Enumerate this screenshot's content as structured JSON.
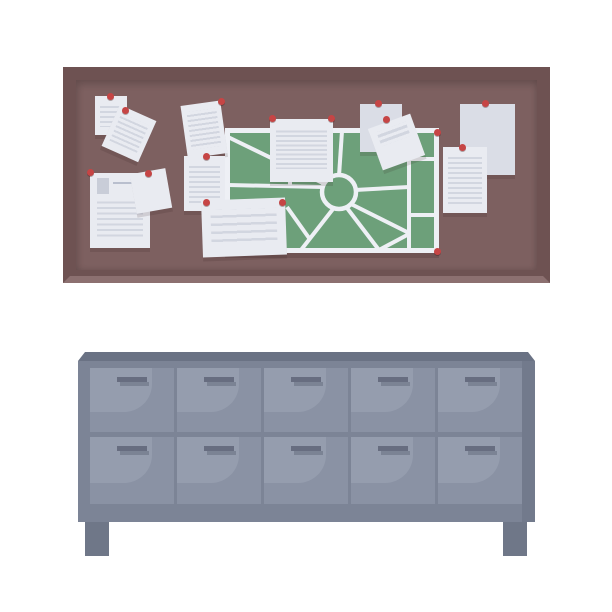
{
  "scene": {
    "description": "flat illustration of a detective evidence cork board with pinned papers and a city map above a gray filing cabinet",
    "background_color": "#ffffff"
  },
  "board": {
    "frame_color": "#6e5252",
    "frame_bevel_color": "#8c7070",
    "surface_color": "#7d6060",
    "pin_color": "#c64545",
    "paper_color": "#e9ebf1",
    "paper_alt_color": "#dadde6",
    "line_color": "#d2d6e0",
    "photo_color": "#c9cdd8",
    "map": {
      "x": 225,
      "y": 128,
      "w": 214,
      "h": 125,
      "land_color": "#6da07a",
      "road_color": "#eef0f5",
      "roundabout": {
        "cx": 114,
        "cy": 64,
        "r": 17
      },
      "roads": [
        [
          3,
          9,
          112,
          62
        ],
        [
          117,
          3,
          114,
          48
        ],
        [
          130,
          62,
          184,
          59
        ],
        [
          184,
          3,
          184,
          122
        ],
        [
          184,
          31,
          211,
          31
        ],
        [
          184,
          87,
          211,
          87
        ],
        [
          126,
          76,
          184,
          105
        ],
        [
          108,
          81,
          76,
          122
        ],
        [
          122,
          80,
          154,
          122
        ],
        [
          154,
          122,
          184,
          106
        ],
        [
          3,
          57,
          98,
          59
        ],
        [
          65,
          57,
          65,
          38
        ],
        [
          62,
          79,
          84,
          110
        ],
        [
          3,
          98,
          40,
          122
        ]
      ]
    },
    "papers": [
      {
        "name": "blank-sheet-back",
        "style": "blank",
        "shade": "alt",
        "x": 360,
        "y": 104,
        "w": 42,
        "h": 48,
        "rot": 0
      },
      {
        "name": "blank-sheet-right",
        "style": "blank",
        "shade": "alt",
        "x": 460,
        "y": 104,
        "w": 55,
        "h": 71,
        "rot": 0
      },
      {
        "name": "case-document",
        "style": "document",
        "shade": "main",
        "x": 90,
        "y": 173,
        "w": 60,
        "h": 75,
        "rot": 0
      },
      {
        "name": "blank-note",
        "style": "blank",
        "shade": "main",
        "x": 133,
        "y": 171,
        "w": 36,
        "h": 40,
        "rot": -10
      },
      {
        "name": "small-note",
        "style": "lined",
        "shade": "main",
        "x": 95,
        "y": 96,
        "w": 32,
        "h": 39,
        "rot": 0
      },
      {
        "name": "tilted-note",
        "style": "lined",
        "shade": "main",
        "x": 109,
        "y": 111,
        "w": 40,
        "h": 45,
        "rot": 24
      },
      {
        "name": "tilted-report",
        "style": "lined",
        "shade": "main",
        "x": 184,
        "y": 103,
        "w": 40,
        "h": 53,
        "rot": -8
      },
      {
        "name": "report-sheet",
        "style": "lined",
        "shade": "main",
        "x": 184,
        "y": 156,
        "w": 41,
        "h": 55,
        "rot": 0
      },
      {
        "name": "center-report",
        "style": "lined-md",
        "shade": "main",
        "x": 270,
        "y": 119,
        "w": 63,
        "h": 63,
        "rot": 0
      },
      {
        "name": "wide-memo",
        "style": "lined-wide",
        "shade": "main",
        "x": 202,
        "y": 199,
        "w": 84,
        "h": 57,
        "rot": -2
      },
      {
        "name": "tilted-note-on-map",
        "style": "lined-top",
        "shade": "main",
        "x": 374,
        "y": 120,
        "w": 45,
        "h": 44,
        "rot": -20
      },
      {
        "name": "right-report",
        "style": "lined",
        "shade": "main",
        "x": 443,
        "y": 147,
        "w": 44,
        "h": 66,
        "rot": 0
      }
    ],
    "pins": [
      [
        110,
        96
      ],
      [
        125,
        110
      ],
      [
        221,
        101
      ],
      [
        206,
        156
      ],
      [
        272,
        118
      ],
      [
        331,
        118
      ],
      [
        90,
        172
      ],
      [
        148,
        173
      ],
      [
        206,
        202
      ],
      [
        282,
        202
      ],
      [
        378,
        103
      ],
      [
        386,
        119
      ],
      [
        437,
        132
      ],
      [
        437,
        251
      ],
      [
        462,
        147
      ],
      [
        485,
        103
      ]
    ]
  },
  "cabinet": {
    "columns": 5,
    "rows": 2,
    "frame_color": "#7c8496",
    "top_color": "#6a7284",
    "right_color": "#727a8c",
    "drawer_color": "#8a92a4",
    "drawer_light_color": "#959dae",
    "handle_color": "#676d80",
    "handle_shadow_color": "#7b8394",
    "foot_color": "#6f7788"
  }
}
